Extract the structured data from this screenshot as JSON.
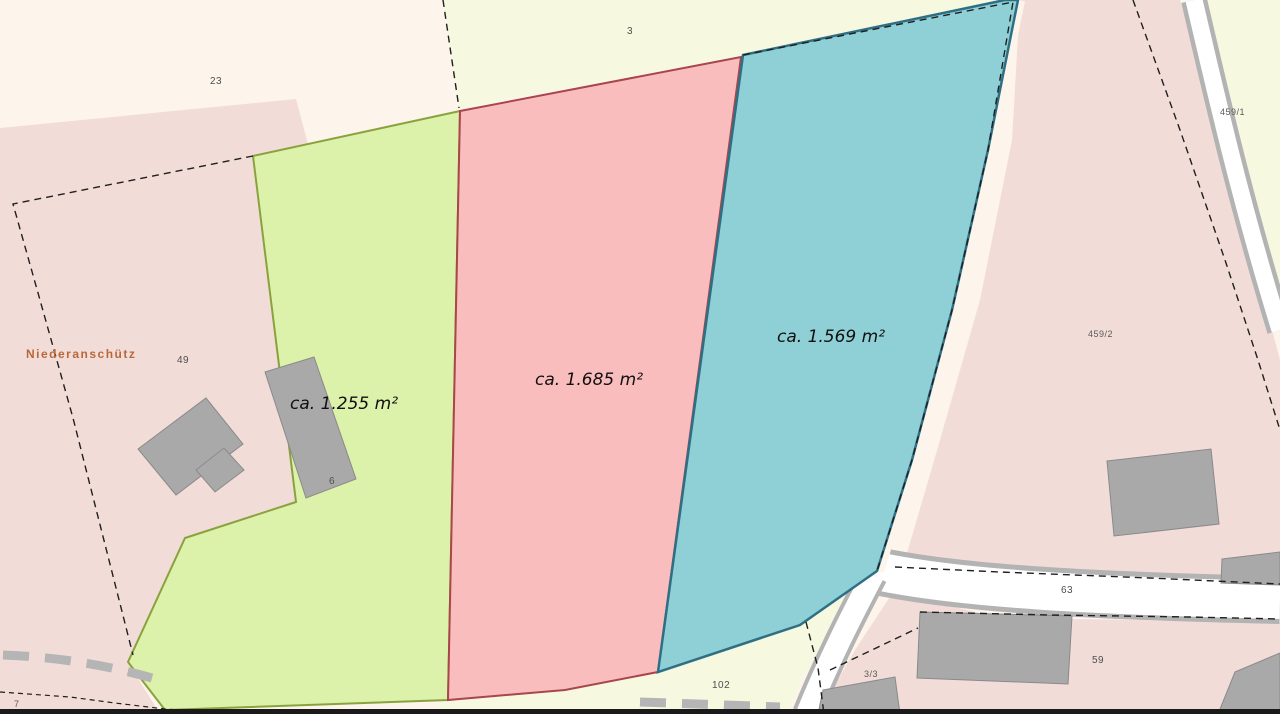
{
  "map": {
    "place_label": {
      "text": "Niederanschütz",
      "color": "#b9683a"
    },
    "parcels": [
      {
        "name": "green-parcel",
        "area_label": "ca. 1.255 m²",
        "fill": "#dcf1a9",
        "stroke": "#8aa23e"
      },
      {
        "name": "red-parcel",
        "area_label": "ca. 1.685 m²",
        "fill": "#f9bdbe",
        "stroke": "#a8464a"
      },
      {
        "name": "blue-parcel",
        "area_label": "ca. 1.569 m²",
        "fill": "#8fd0d6",
        "stroke": "#2f6f85"
      }
    ],
    "parcel_numbers": [
      {
        "text": "23"
      },
      {
        "text": "3"
      },
      {
        "text": "459/1"
      },
      {
        "text": "49"
      },
      {
        "text": "6"
      },
      {
        "text": "459/2"
      },
      {
        "text": "63"
      },
      {
        "text": "59"
      },
      {
        "text": "3/3"
      },
      {
        "text": "102"
      },
      {
        "text": "7"
      }
    ],
    "colors": {
      "background": "#fdf5ec",
      "pale_field": "#f6f8e0",
      "village_pink": "#f2dcd8",
      "road_fill": "#ffffff",
      "road_casing": "#b3b3b3",
      "building_fill": "#a9a9a9",
      "building_stroke": "#8a8a8a",
      "boundary_dash": "#1f1f1f",
      "track_dash": "#b5b5b5"
    }
  }
}
